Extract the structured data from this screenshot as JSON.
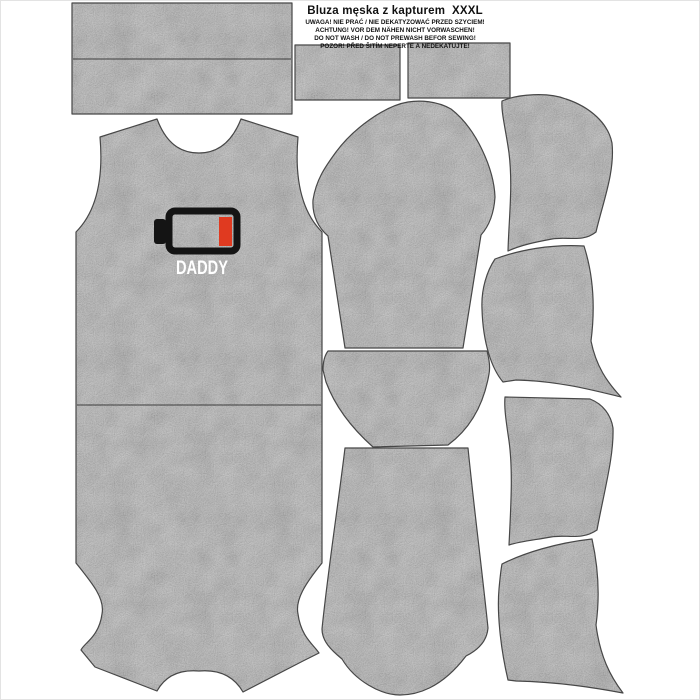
{
  "product": {
    "title": "Bluza męska z kapturem  XXXL",
    "warnings": [
      "UWAGA! NIE PRAĆ / NIE DEKATYZOWAĆ PRZED SZYCIEM!",
      "ACHTUNG! VOR DEM NÄHEN NICHT VORWASCHEN!",
      "DO NOT WASH / DO NOT PREWASH BEFOR SEWING!",
      "POZOR! PŘED ŠITÍM NEPERTE A NEDEKATUJTE!"
    ]
  },
  "print": {
    "text": "DADDY",
    "icon": "low-battery-icon",
    "outline_color": "#141414",
    "charge_color": "#e03a20",
    "text_color": "#ffffff"
  },
  "fabric": {
    "base_color": "#a2a2a2",
    "outline_color": "#474747",
    "background_color": "#ffffff",
    "appearance": "heather gray melange"
  },
  "pieces": [
    "waistband",
    "cuff-left",
    "cuff-right",
    "front-panel-with-print",
    "sleeve-top",
    "pocket-facing",
    "sleeve-bottom",
    "hood-side-1",
    "hood-side-2",
    "hood-side-3",
    "hood-side-4"
  ]
}
